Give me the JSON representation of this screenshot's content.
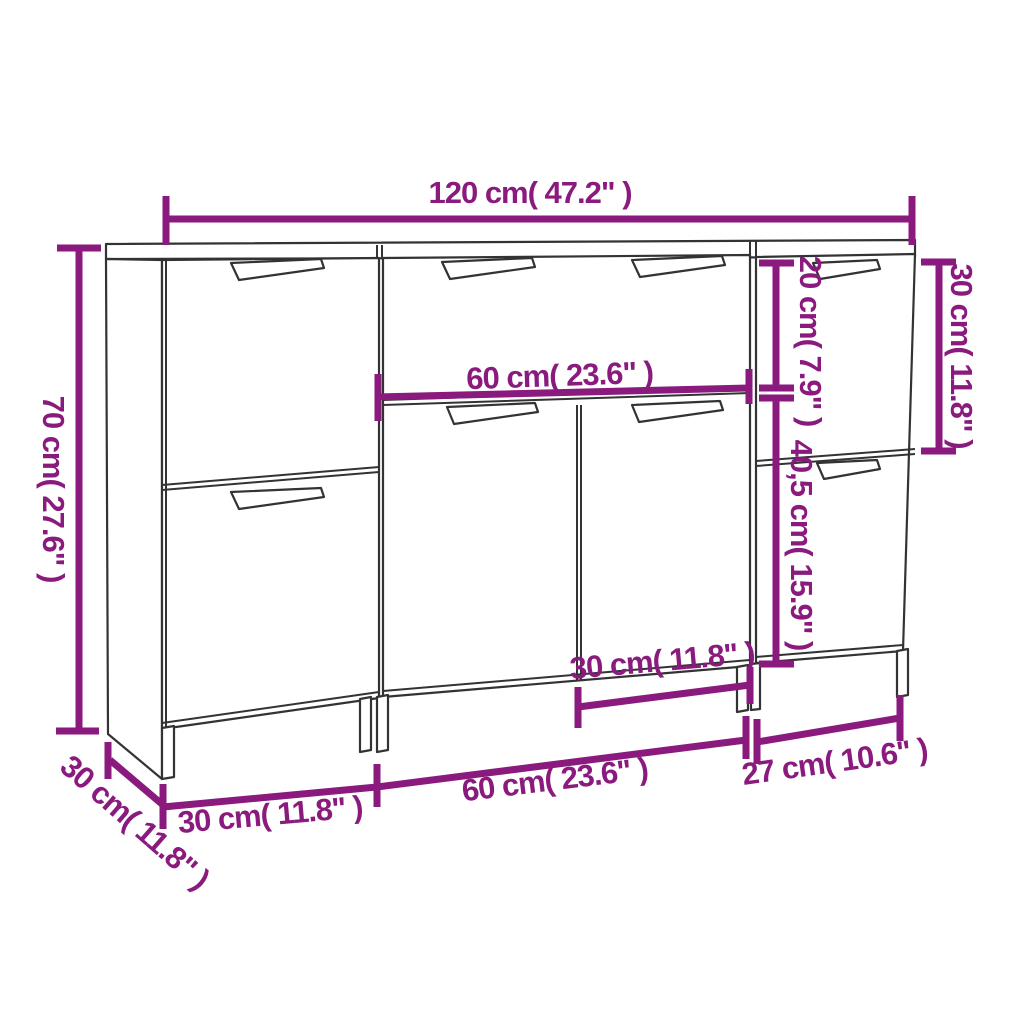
{
  "diagram": {
    "type": "furniture-dimension-diagram",
    "subject": "3-piece sideboard front view with measurements",
    "background_color": "#ffffff",
    "outline_color": "#333333",
    "accent_color": "#8a1a7d",
    "units_shown": [
      "cm",
      "inches"
    ],
    "dimensions": {
      "total_width": "120 cm( 47.2\" )",
      "height_left": "70 cm( 27.6\" )",
      "depth_left": "30 cm( 11.8\" )",
      "drawer_height_right": "20 cm( 7.9\" )",
      "right_top_height": "30 cm( 11.8\" )",
      "right_door_height": "40,5 cm( 15.9\" )",
      "middle_drawer_width": "60 cm( 23.6\" )",
      "middle_door_width": "30 cm( 11.8\" )",
      "bottom_left_width": "30 cm( 11.8\" )",
      "bottom_middle_width": "60 cm( 23.6\" )",
      "bottom_right_width": "27 cm( 10.6\" )"
    }
  }
}
